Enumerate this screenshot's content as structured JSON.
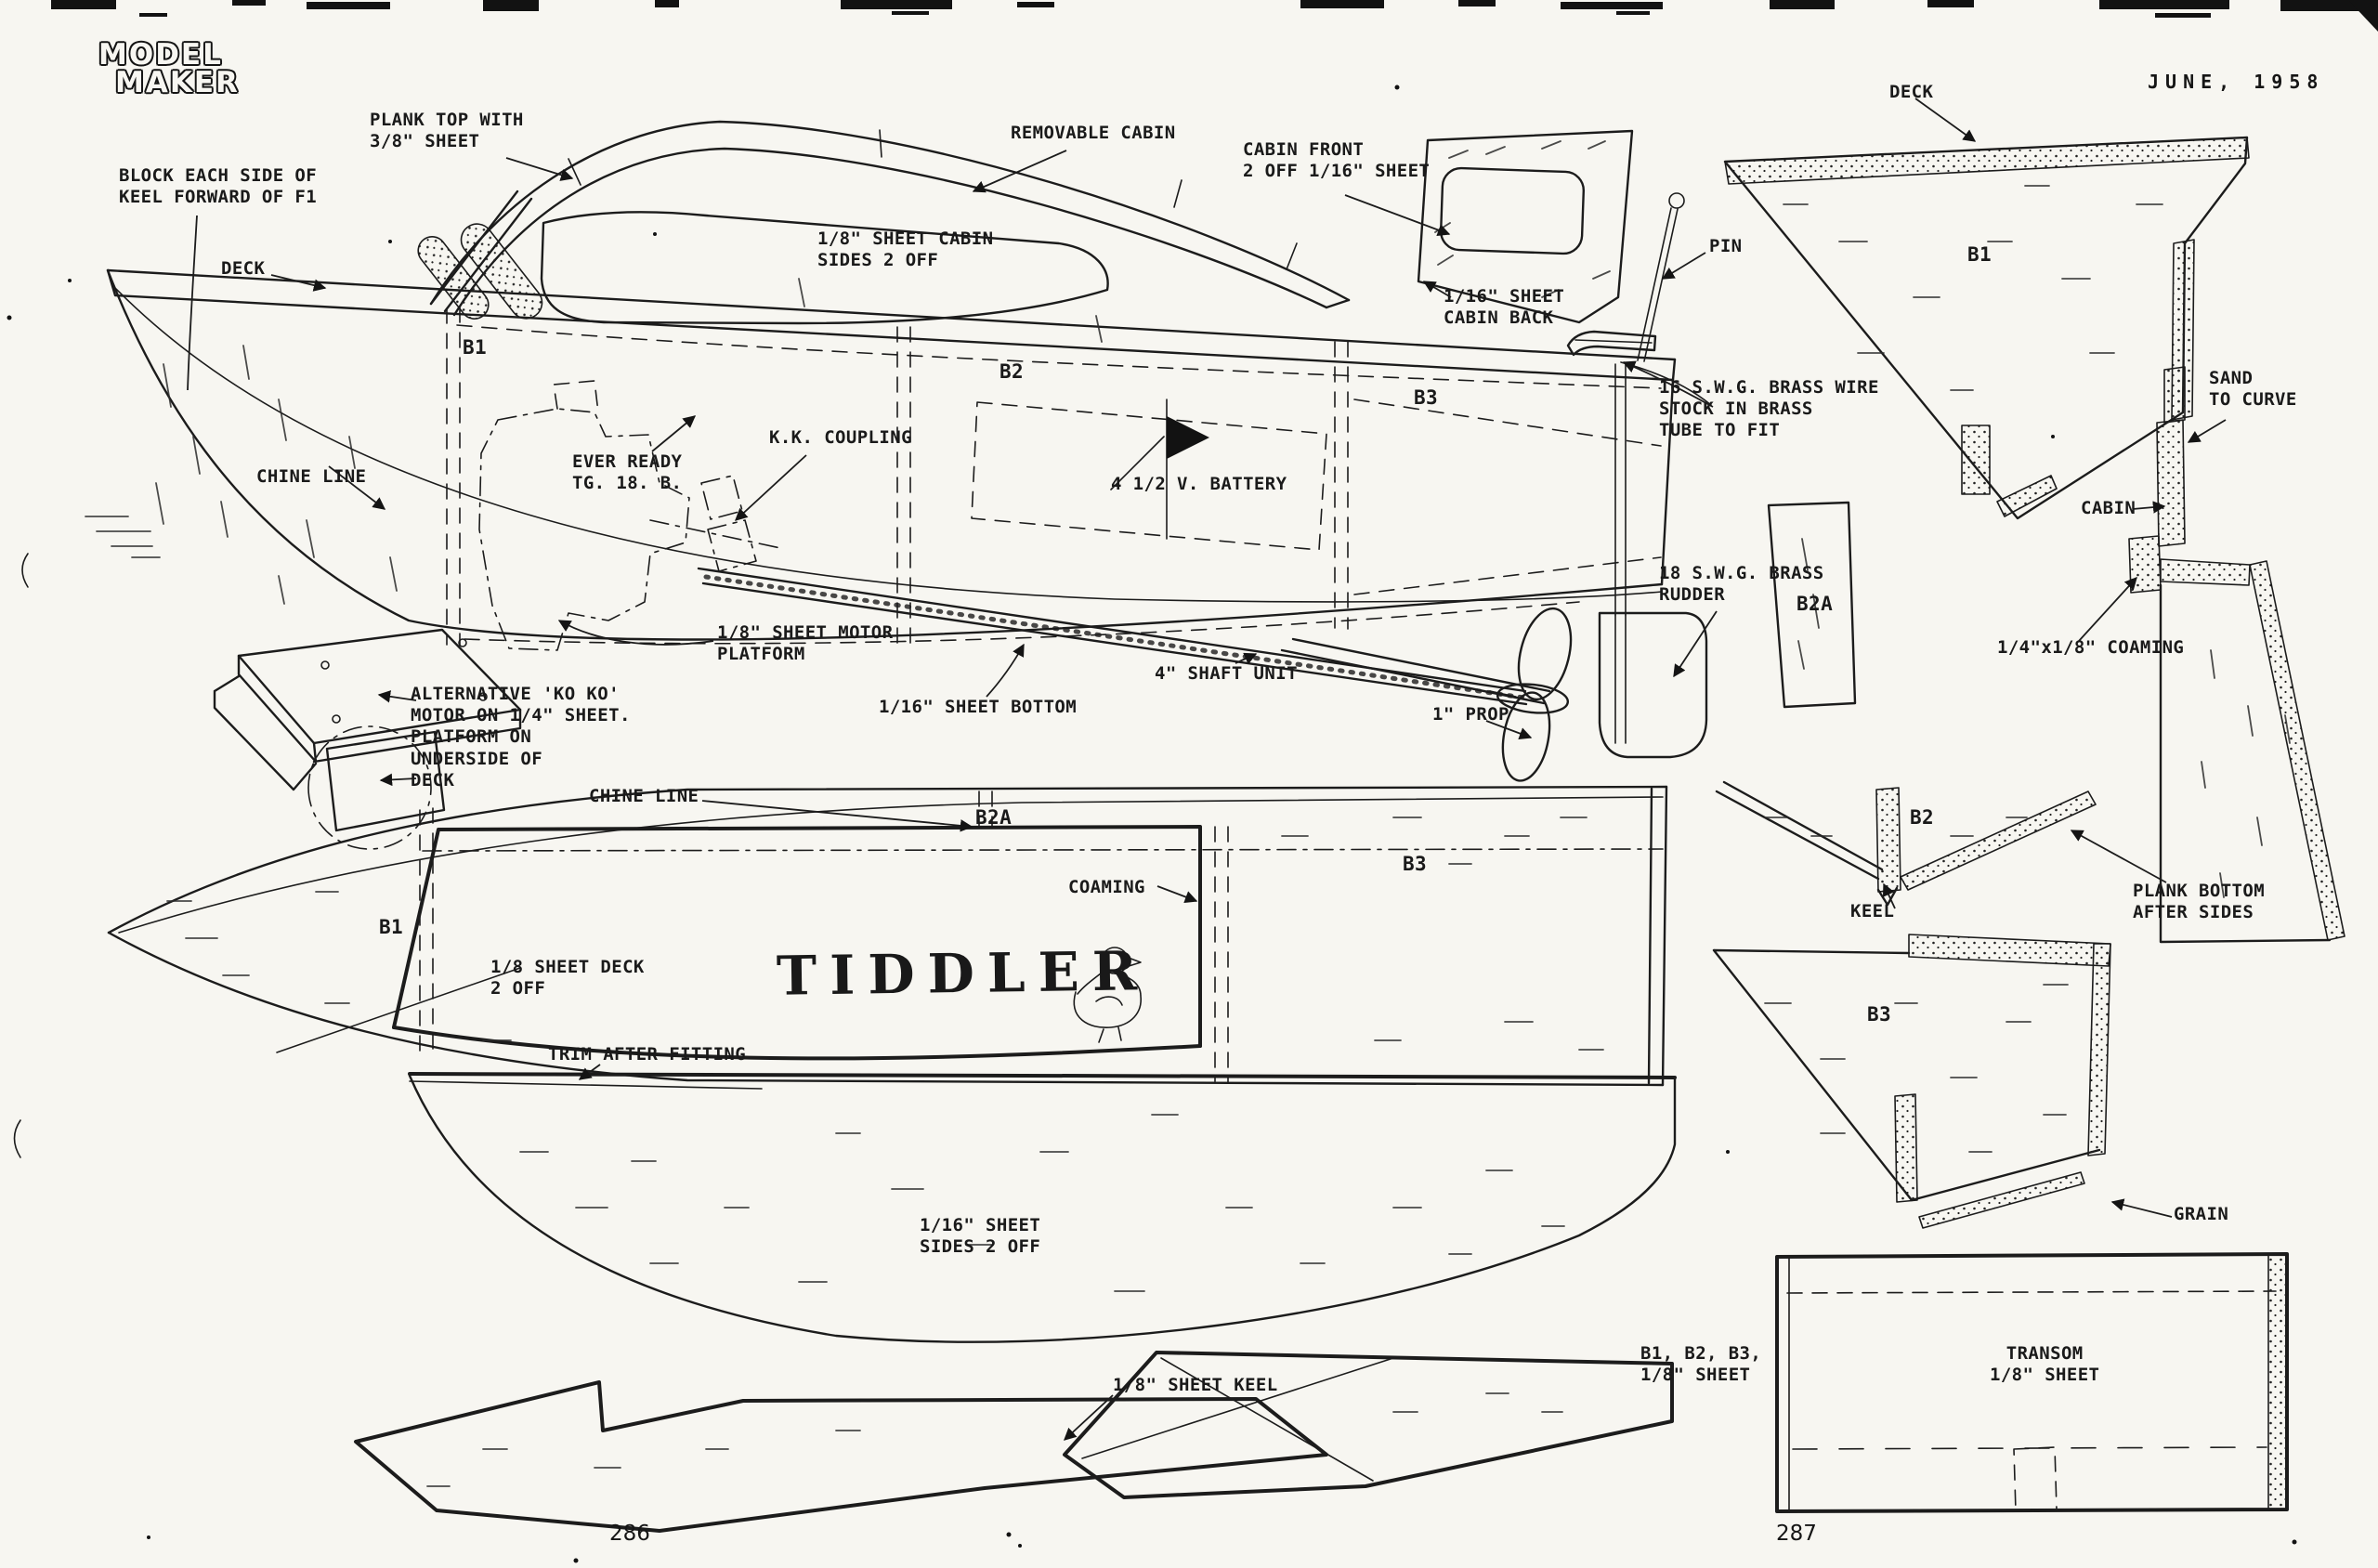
{
  "page": {
    "magazine_line1": "MODEL",
    "magazine_line2": "MAKER",
    "issue_date": "JUNE, 1958",
    "page_number_left": "286",
    "page_number_right": "287",
    "boat_name": "TIDDLER"
  },
  "labels": {
    "plank_top": "PLANK TOP WITH\n3/8\" SHEET",
    "block_keel": "BLOCK EACH SIDE OF\nKEEL FORWARD OF F1",
    "deck_side": "DECK",
    "removable_cabin": "REMOVABLE CABIN",
    "cabin_front": "CABIN FRONT\n2 OFF 1/16\" SHEET",
    "cabin_sides": "1/8\" SHEET CABIN\nSIDES 2 OFF",
    "cabin_back": "1/16\" SHEET\nCABIN BACK",
    "pin": "PIN",
    "deck_pattern": "DECK",
    "b1_pattern": "B1",
    "sand_to_curve": "SAND\nTO CURVE",
    "brass_wire": "16 S.W.G. BRASS WIRE\nSTOCK IN BRASS\nTUBE TO FIT",
    "chine_line_side": "CHINE LINE",
    "ever_ready": "EVER READY\nTG. 18. B.",
    "kk_coupling": "K.K. COUPLING",
    "battery": "4 1/2 V. BATTERY",
    "b1_side": "B1",
    "b2_side": "B2",
    "b3_side": "B3",
    "cabin_section": "CABIN",
    "rudder": "18 S.W.G. BRASS\nRUDDER",
    "b2a_pattern": "B2A",
    "coaming_section": "1/4\"x1/8\" COAMING",
    "motor_platform": "1/8\" SHEET MOTOR\nPLATFORM",
    "shaft_unit": "4\" SHAFT UNIT",
    "sheet_bottom": "1/16\" SHEET BOTTOM",
    "prop": "1\" PROP",
    "alt_motor": "ALTERNATIVE 'KO KO'\nMOTOR ON 1/4\" SHEET.\nPLATFORM ON\nUNDERSIDE OF\nDECK",
    "chine_line_plan": "CHINE LINE",
    "b2a_plan": "B2A",
    "b3_plan": "B3",
    "coaming_plan": "COAMING",
    "b1_plan": "B1",
    "sheet_deck": "1/8 SHEET DECK\n2 OFF",
    "b2_pattern": "B2",
    "keel": "KEEL",
    "plank_bottom": "PLANK BOTTOM\nAFTER SIDES",
    "b3_pattern": "B3",
    "trim_after_fitting": "TRIM AFTER FITTING",
    "sheet_sides": "1/16\" SHEET\nSIDES 2 OFF",
    "grain": "GRAIN",
    "b123_sheet": "B1, B2, B3,\n1/8\" SHEET",
    "transom": "TRANSOM\n1/8\" SHEET",
    "sheet_keel": "1/8\" SHEET KEEL"
  }
}
